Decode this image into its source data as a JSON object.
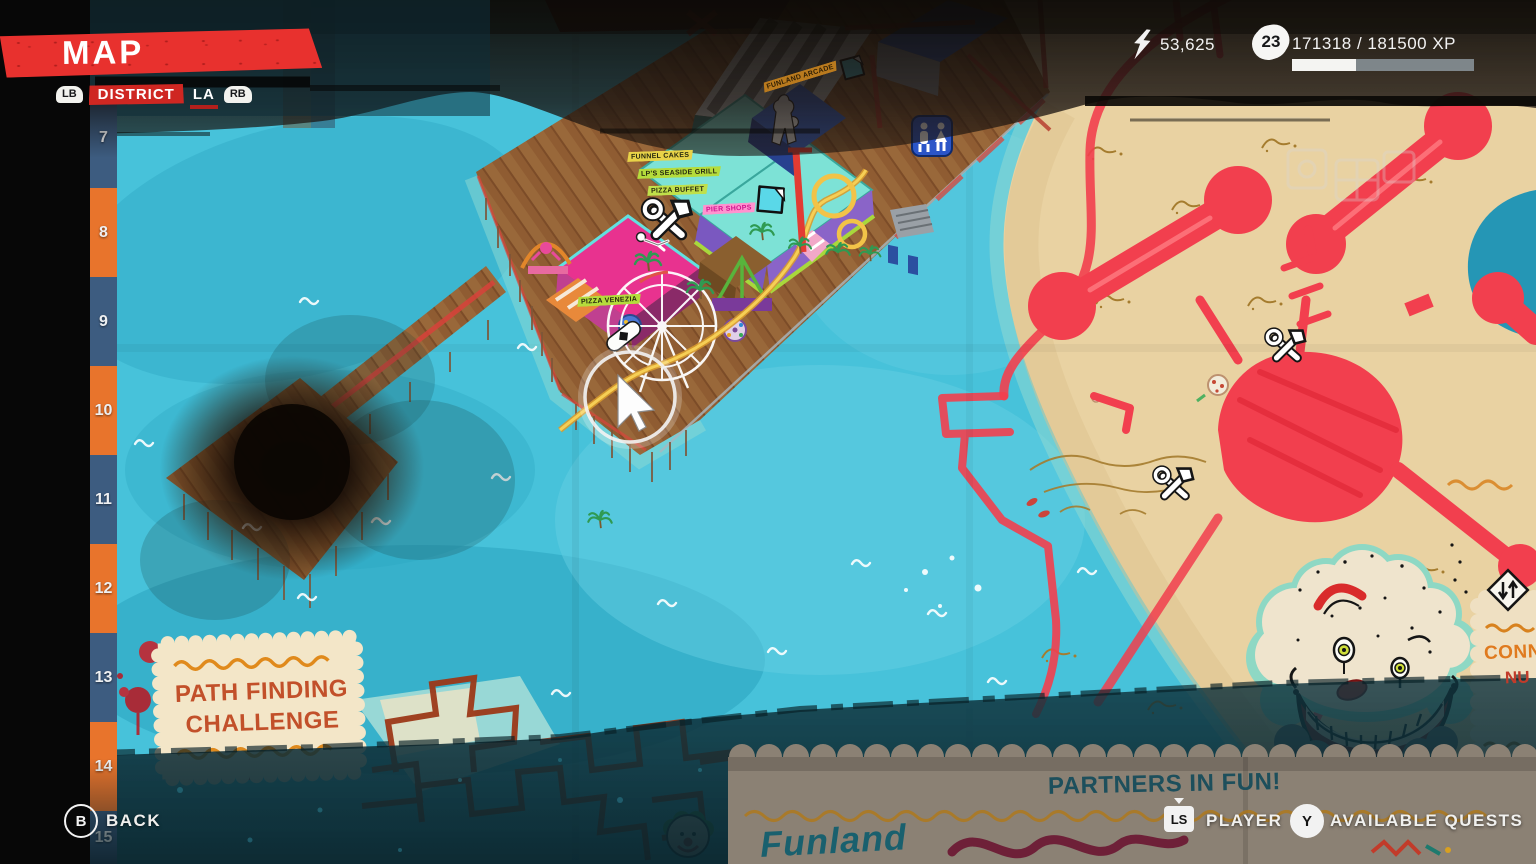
{
  "colors": {
    "accent_red": "#e8312e",
    "ocean": "#47c2da",
    "ocean_deep": "#2fa9c4",
    "sand": "#e9d2a2",
    "pier_wood": "#8f5c32",
    "ruler_blue": "#3d5c80",
    "ruler_orange": "#e8742c",
    "crayon_red": "#f23f4e",
    "note_paper": "#f3e6c8"
  },
  "hud": {
    "title": "MAP",
    "district_nav": {
      "lb": "LB",
      "mode": "DISTRICT",
      "current": "LA",
      "rb": "RB"
    },
    "currency": {
      "icon": "cash-lightning-icon",
      "amount": "53,625"
    },
    "level": {
      "value": "23"
    },
    "xp": {
      "text": "171318 / 181500 XP",
      "percent": 35,
      "fill_style": "width:35%"
    },
    "footer": {
      "back_key": "B",
      "back_label": "BACK",
      "player_key": "LS",
      "player_label": "PLAYER",
      "quests_key": "Y",
      "quests_label": "AVAILABLE QUESTS"
    }
  },
  "ruler": {
    "items": [
      {
        "label": "7"
      },
      {
        "label": "8"
      },
      {
        "label": "9"
      },
      {
        "label": "10"
      },
      {
        "label": "11"
      },
      {
        "label": "12"
      },
      {
        "label": "13"
      },
      {
        "label": "14"
      },
      {
        "label": "15"
      }
    ]
  },
  "map": {
    "location_labels": [
      {
        "text": "FUNNEL CAKES"
      },
      {
        "text": "LP'S SEASIDE GRILL"
      },
      {
        "text": "PIZZA BUFFET"
      },
      {
        "text": "PIER SHOPS"
      },
      {
        "text": "PIZZA VENEZIA"
      },
      {
        "text": "FUNLAND ARCADE"
      }
    ],
    "notes": {
      "path_challenge_line1": "PATH FINDING",
      "path_challenge_line2": "CHALLENGE",
      "partners_title": "PARTNERS IN FUN!",
      "partners_logo": "Funland",
      "connect_line1": "CONN",
      "connect_line2": "NU"
    },
    "icons": [
      "workbench-icon",
      "fast-travel-icon",
      "map-stand-icon",
      "restroom-icon",
      "player-marker-icon",
      "corpse-icon",
      "player-cursor"
    ]
  }
}
